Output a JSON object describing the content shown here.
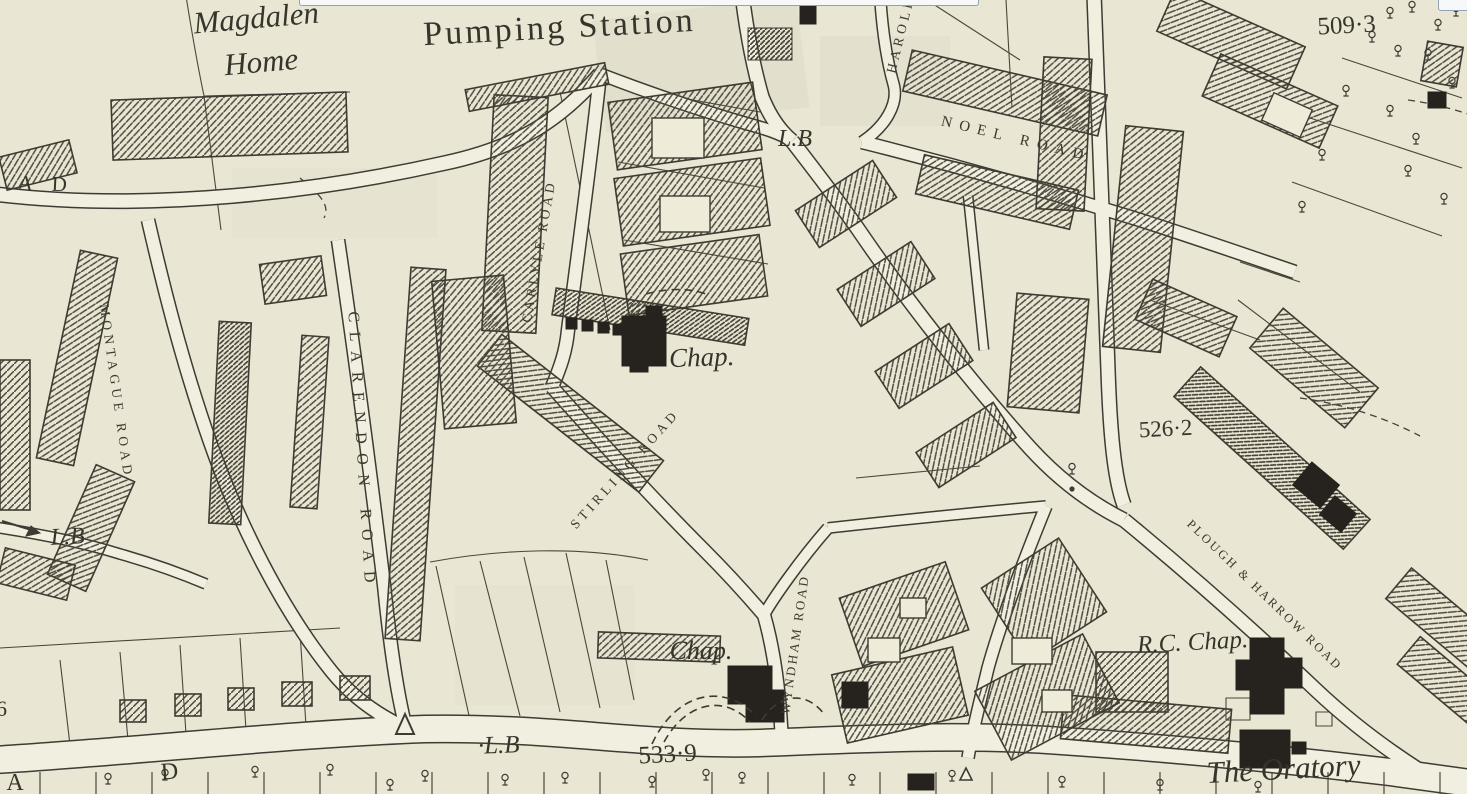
{
  "map": {
    "colors": {
      "paper": "#e9e6d3",
      "ink": "#3e3b33",
      "road_fill": "#f1efe0",
      "solid_building": "#26231e",
      "shade": "#e0ddcb",
      "overlay_border": "#93a1b2"
    },
    "labels": {
      "magdalen": {
        "text": "Magdalen"
      },
      "home": {
        "text": "Home"
      },
      "pumping_station": {
        "text": "Pumping Station"
      },
      "lb_top": {
        "text": "L.B"
      },
      "harold_road": {
        "text": "HAROLD"
      },
      "noel_road": {
        "text": "NOEL ROAD"
      },
      "spot_509": {
        "text": "509·3"
      },
      "frag_a_top": {
        "text": "A"
      },
      "frag_d_top": {
        "text": "D"
      },
      "montague_road": {
        "text": "MONTAGUE ROAD"
      },
      "clarendon_road": {
        "text": "CLARENDON ROAD"
      },
      "carlyle_road": {
        "text": "CARLYLE ROAD"
      },
      "chap_north": {
        "text": "Chap."
      },
      "stirling_road": {
        "text": "STIRLING ROAD"
      },
      "lb_west": {
        "text": "L.B"
      },
      "spot_526": {
        "text": "526·2"
      },
      "plough_harrow": {
        "text": "PLOUGH & HARROW ROAD"
      },
      "rc_chap": {
        "text": "R.C. Chap."
      },
      "wyndham_road": {
        "text": "WYNDHAM ROAD"
      },
      "chap_south": {
        "text": "Chap."
      },
      "spot_533": {
        "text": "533·9"
      },
      "lb_south": {
        "text": "·L.B"
      },
      "frag_d_bottom": {
        "text": "D"
      },
      "frag_a_bottom": {
        "text": "A"
      },
      "frag_6_left": {
        "text": "6"
      },
      "the_oratory": {
        "text": "The Oratory"
      }
    }
  }
}
